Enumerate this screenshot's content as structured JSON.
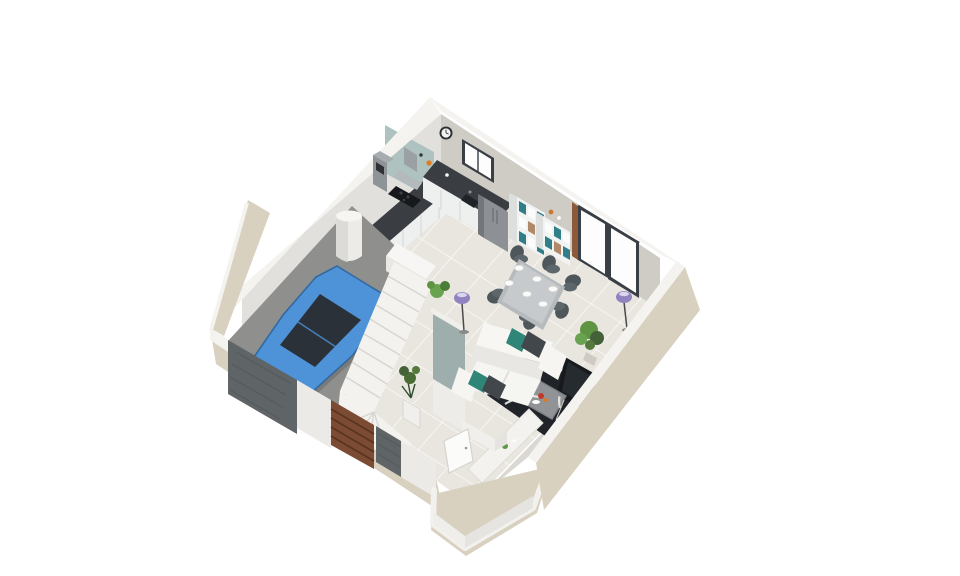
{
  "scene": {
    "type": "3d-isometric-floor-plan",
    "view": "elevated three-quarter isometric view of a ground floor, cut walls, on a plain white background",
    "background": "#ffffff",
    "description": "Rendered ground floor of a small house: open kitchen with dark L-shaped worktop, living-dining room with white sofa and patterned rug, winder staircase with teal guard wall, entrance hall with WC, and a single-car garage containing a blue hatchback."
  },
  "palette": {
    "bg": "#ffffff",
    "wall_outer": "#d9d1c0",
    "wall_top": "#f4f3f0",
    "wall_inner_nw": "#e2e0dc",
    "wall_inner_ne": "#cfccc6",
    "wall_inner_se": "#dbd8d3",
    "backsplash_teal": "#aec2c0",
    "floor_tile": "#e9e6e0",
    "tile_line": "#f9f8f5",
    "garage_floor": "#8f8f8d",
    "stair_white": "#f3f2ee",
    "stair_shadow": "#d8d6d1",
    "balustrade_teal": "#9daeac",
    "car_blue": "#4e92d8",
    "car_blue_dark": "#32699f",
    "car_glass": "#2b3138",
    "counter_top": "#3a3e42",
    "cabinet_white": "#eef0f0",
    "fridge_gray": "#8d9195",
    "shelf_teal": "#2f7e88",
    "frame_dark": "#3a3f45",
    "glass_white": "#fdfdfd",
    "table_gray": "#b6babd",
    "chair_dark": "#4e575b",
    "sofa_white": "#f5f5f2",
    "cushion_teal": "#2f8577",
    "cushion_dark": "#42474b",
    "rug_black": "#202327",
    "rug_white": "#eceae6",
    "tv_black": "#17191d",
    "plant_green": "#5f9443",
    "plant_dark": "#446238",
    "lamp_purple": "#9183c0",
    "door_brown": "#7c4b33",
    "door_brown_dark": "#59341f",
    "dark_wall": "#5f6466",
    "wood": "#8a5a3b"
  },
  "rooms": [
    {
      "id": "kitchen",
      "furniture": [
        "L-shaped counter with dark worktop",
        "range hood",
        "cooktop",
        "sink",
        "tall oven unit",
        "double-door fridge",
        "wall clock",
        "window",
        "shelf unit with teal storage boxes"
      ]
    },
    {
      "id": "living-dining",
      "furniture": [
        "dining table set with 6 plates",
        "6 dark chairs",
        "sliding glass door",
        "white sofa with teal and grey cushions",
        "black-and-white patterned rug",
        "glass coffee table",
        "television",
        "white console bench",
        "2 purple floor lamps",
        "green plants"
      ]
    },
    {
      "id": "garage",
      "furniture": [
        "blue hatchback car",
        "water heater cylinder",
        "brown garage door"
      ]
    },
    {
      "id": "hall",
      "furniture": [
        "winder staircase",
        "teal guard wall",
        "white entrance door",
        "WC"
      ]
    }
  ],
  "counts": {
    "dining_chairs": 6,
    "plates": 6,
    "floor_lamps": 2,
    "sliding_door_panels": 2,
    "stair_steps_visible": 12,
    "cars": 1
  }
}
